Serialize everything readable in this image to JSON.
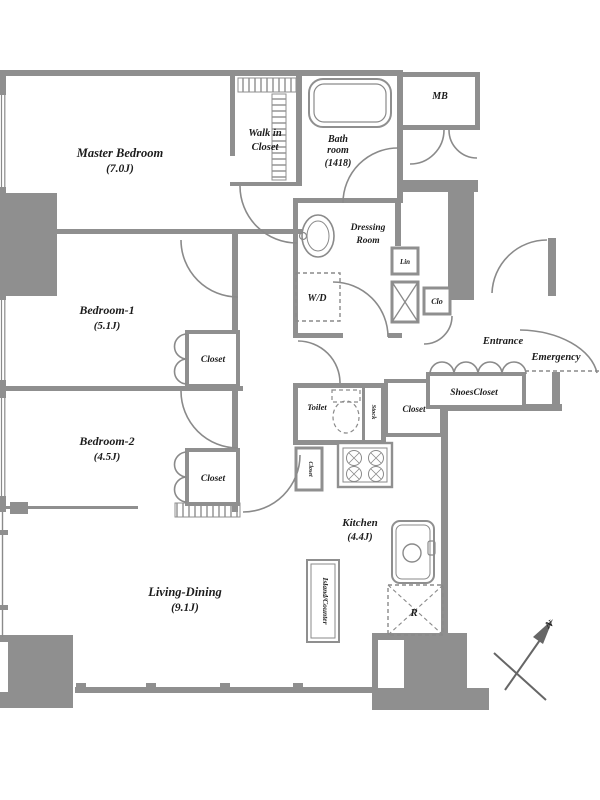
{
  "plan": {
    "colors": {
      "wall": "#8f8f8f",
      "pillar": "#9b9b9b",
      "line": "#8a8a8a",
      "text": "#1c1c1c",
      "bg": "#ffffff"
    },
    "rooms": {
      "master_bedroom": {
        "name": "Master Bedroom",
        "size": "(7.0J)"
      },
      "walk_in_closet": {
        "line1": "Walk in",
        "line2": "Closet"
      },
      "bathroom": {
        "line1": "Bath",
        "line2": "room",
        "line3": "(1418)"
      },
      "meter_box": "MB",
      "dressing_room": {
        "line1": "Dressing",
        "line2": "Room"
      },
      "washer_dryer": "W/D",
      "linen": "Lin",
      "clo": "Clo",
      "entrance": "Entrance",
      "shoes_closet": "ShoesCloset",
      "emergency": "Emergency",
      "toilet": "Toilet",
      "stock": "Stock",
      "closet_hall": "Closet",
      "closet_small": "Closet",
      "bedroom1": {
        "name": "Bedroom-1",
        "size": "(5.1J)"
      },
      "closet_bedroom1": "Closet",
      "bedroom2": {
        "name": "Bedroom-2",
        "size": "(4.5J)"
      },
      "closet_bedroom2": "Closet",
      "kitchen": {
        "name": "Kitchen",
        "size": "(4.4J)"
      },
      "island_counter": "Island/Counter",
      "refrigerator": "R",
      "living_dining": {
        "name": "Living-Dining",
        "size": "(9.1J)"
      }
    },
    "compass": {
      "north": "N"
    }
  }
}
